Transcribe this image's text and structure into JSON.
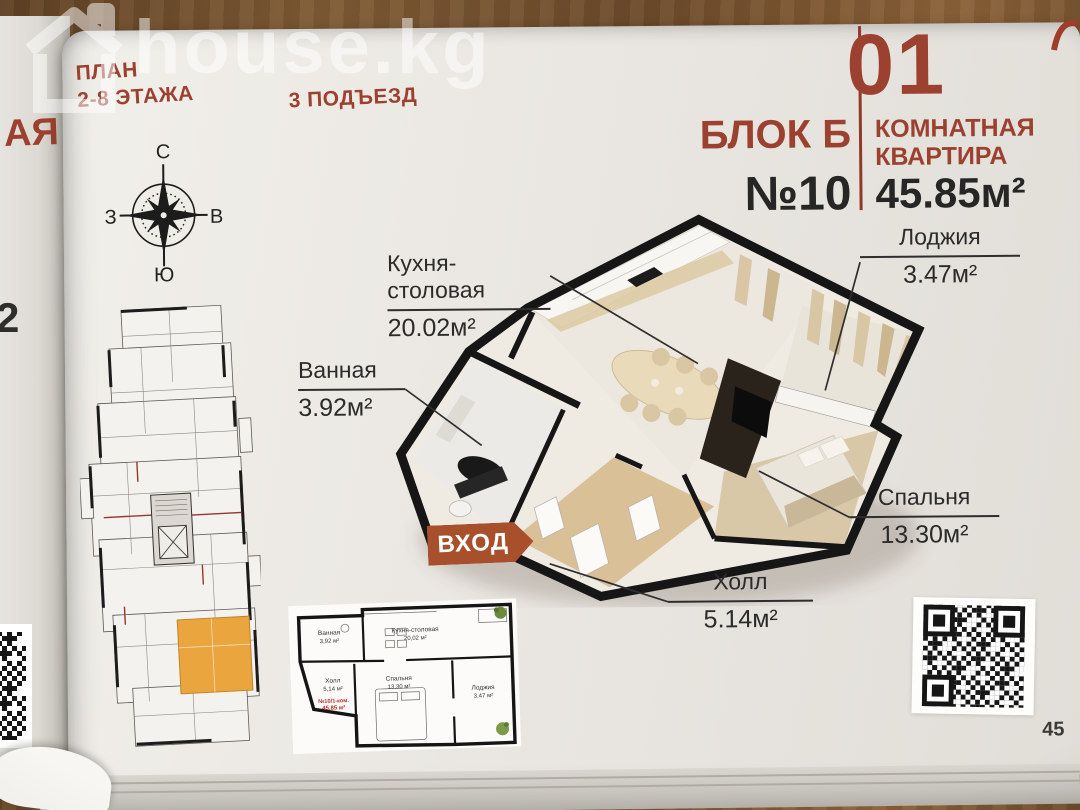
{
  "meta": {
    "watermark": "house.kg",
    "page_number": "45"
  },
  "header": {
    "plan_line1": "ПЛАН",
    "plan_line2": "2-8 ЭТАЖА",
    "entrance": "3 ПОДЪЕЗД",
    "big_number": "01",
    "block": "БЛОК Б",
    "apartment_no": "№10",
    "type_line1": "КОМНАТНАЯ",
    "type_line2": "КВАРТИРА",
    "total_area": "45.85м²"
  },
  "compass": {
    "n": "С",
    "s": "Ю",
    "w": "З",
    "e": "В"
  },
  "badge": {
    "entrance": "ВХОД"
  },
  "rooms": {
    "kitchen": {
      "name": "Кухня-столовая",
      "area": "20.02м²"
    },
    "loggia": {
      "name": "Лоджия",
      "area": "3.47м²"
    },
    "bath": {
      "name": "Ванная",
      "area": "3.92м²"
    },
    "bedroom": {
      "name": "Спальня",
      "area": "13.30м²"
    },
    "hall": {
      "name": "Холл",
      "area": "5.14м²"
    }
  },
  "mini_plan": {
    "bath": {
      "name": "Ванная",
      "area": "3,92 м²"
    },
    "kitchen": {
      "name": "Кухня-столовая",
      "area": "20,02 м²"
    },
    "hall": {
      "name": "Холл",
      "area": "5,14 м²"
    },
    "bedroom": {
      "name": "Спальня",
      "area": "13,30 м²"
    },
    "loggia": {
      "name": "Лоджия",
      "area": "3,47 м²"
    },
    "unit_line1": "№10/1-ком.",
    "unit_line2": "45,85 м²"
  },
  "prev_page": {
    "fragment1": "АЯ",
    "fragment2": "2"
  },
  "colors": {
    "accent": "#9C4130",
    "badge_orange": "#A8502C",
    "highlight_orange": "#E8A43E",
    "ink": "#262626"
  }
}
